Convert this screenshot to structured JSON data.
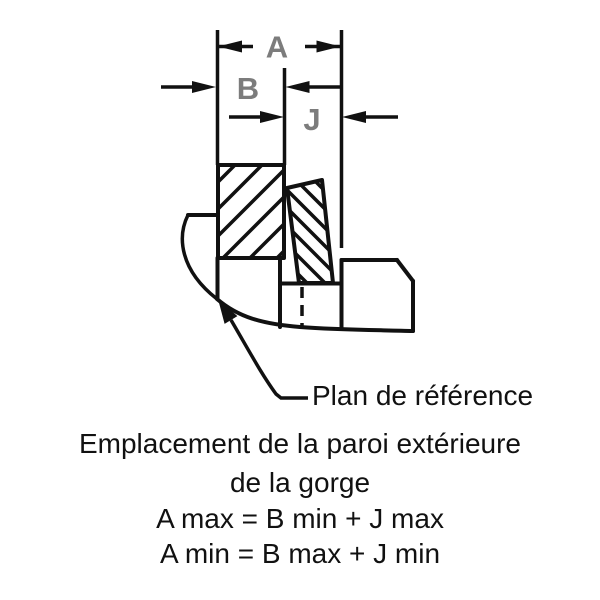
{
  "diagram": {
    "dimension_labels": {
      "a": "A",
      "b": "B",
      "j": "J"
    },
    "colors": {
      "stroke": "#111111",
      "dimension_label": "#7c7c7c",
      "background": "#ffffff"
    }
  },
  "annotations": {
    "leader_label": "Plan de référence",
    "caption_lines": [
      "Emplacement de la paroi extérieure",
      "de la gorge"
    ],
    "formulas": [
      "A max = B min + J max",
      "A min = B max + J min"
    ]
  }
}
